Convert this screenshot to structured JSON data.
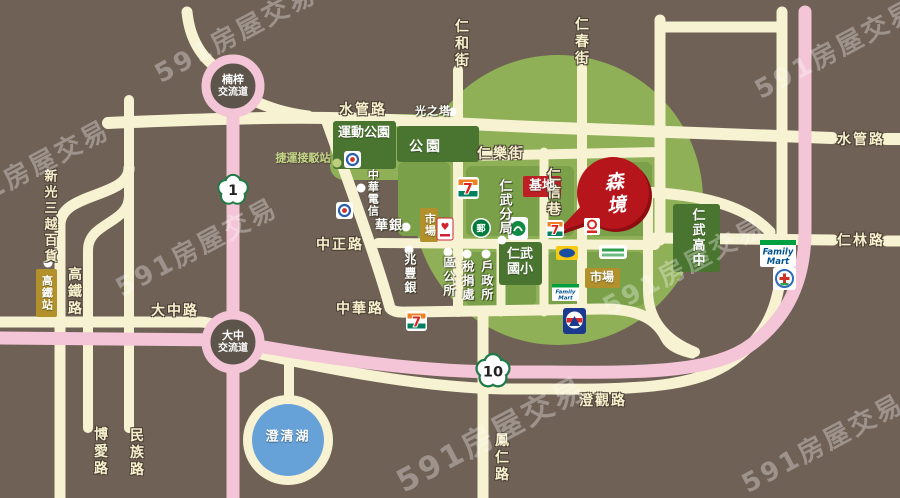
{
  "watermark": {
    "text": "591房屋交易"
  },
  "interchanges": {
    "nanzi": {
      "line1": "楠梓",
      "line2": "交流道"
    },
    "dazhong": {
      "line1": "大中",
      "line2": "交流道"
    }
  },
  "highway_shields": {
    "route1": "1",
    "route10": "10"
  },
  "road_labels": {
    "shuiguan_west": "水管路",
    "shuiguan_east": "水管路",
    "renhe_st": "仁和街",
    "renchun_st": "仁春街",
    "renle_st": "仁樂街",
    "renxin_lane": "仁信巷",
    "zhongzheng_rd": "中正路",
    "zhonghua_rd": "中華路",
    "dazhong_rd": "大中路",
    "renlin_rd": "仁林路",
    "chengguan_rd": "澄觀路",
    "fengren_rd": "鳳仁路",
    "gaotie_rd": "高鐵路",
    "boai_rd": "博愛路",
    "minzu_rd": "民族路"
  },
  "project": {
    "name": "森境",
    "site_label": "基地"
  },
  "green_boxes": {
    "sports_park": "運動公園",
    "park": "公園",
    "high_school": "仁武高中",
    "elementary_line1": "仁武",
    "elementary_line2": "國小"
  },
  "olive_boxes": {
    "market_west": "市場",
    "market_east": "市場",
    "hsr_station": "高鐵站"
  },
  "poi": {
    "light_tower": "光之塔",
    "mrt_shuttle": "捷運接駁站",
    "cht": "中華電信",
    "huanan_bank": "華銀",
    "mega_bank": "兆豐銀",
    "police_branch": "仁武分局",
    "district_office": "區公所",
    "tax_office": "稅捐處",
    "household_office": "戶政所",
    "shinkong_mitsukoshi": "新光三越百貨"
  },
  "landmarks": {
    "lake": "澄清湖"
  },
  "stores": {
    "family_mart_line1": "Family",
    "family_mart_line2": "Mart",
    "seven_eleven_glyph": "7",
    "post_office_glyph": "郵"
  },
  "colors": {
    "background": "#6f6156",
    "road_cream": "#f7f2d2",
    "highway_pink": "#f3c5d7",
    "green_zone": "#8fb057",
    "green_block": "#7aa149",
    "dark_green_box": "#4a7530",
    "olive_box": "#b2902b",
    "site_red": "#bf1e24",
    "project_red": "#b5151b",
    "lake_blue": "#66a1d8",
    "interchange_fill": "#5d544b",
    "shield_green": "#1e7a46",
    "mrt_text_green": "#c5d687"
  }
}
